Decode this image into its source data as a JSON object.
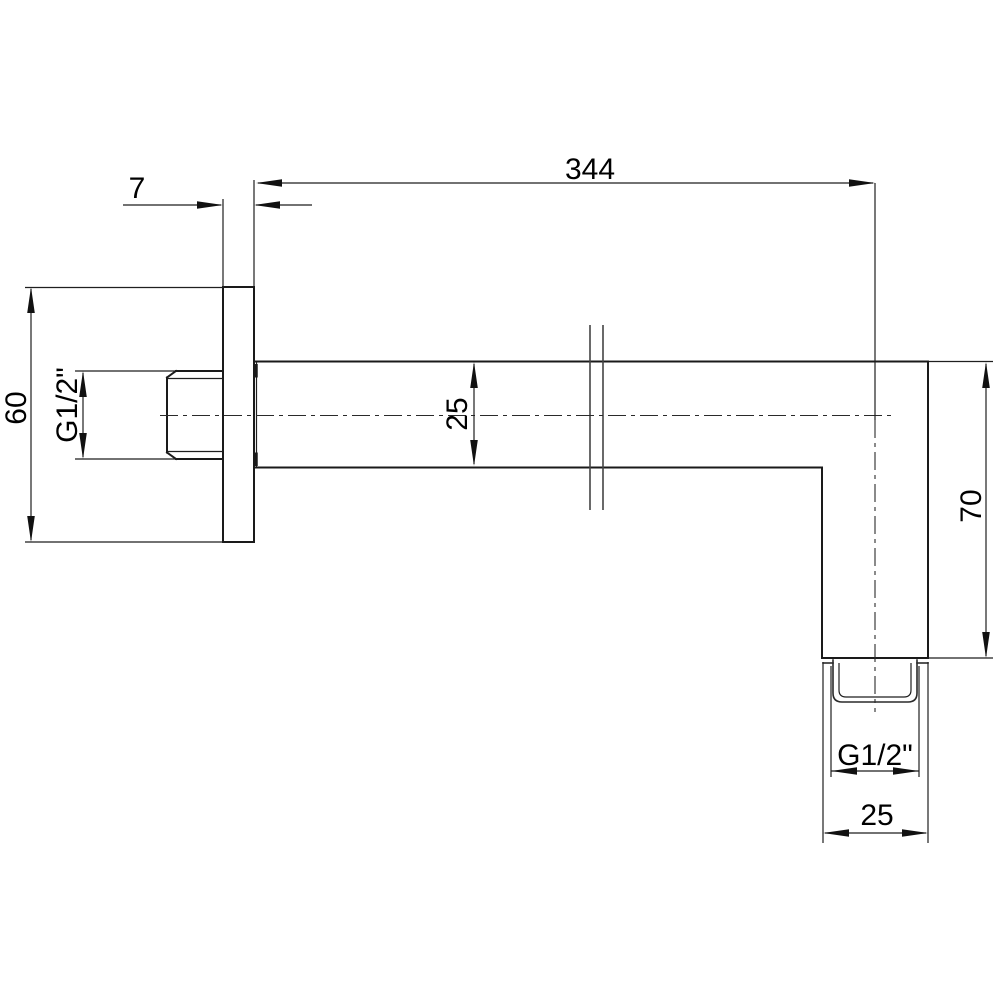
{
  "drawing": {
    "title": "shower-arm-technical-drawing",
    "labels": {
      "flange_thickness": "7",
      "arm_length": "344",
      "flange_size": "60",
      "wall_thread": "G1/2\"",
      "arm_profile": "25",
      "drop_length": "70",
      "outlet_thread": "G1/2\"",
      "outlet_width": "25"
    },
    "colors": {
      "line": "#1a1a1a",
      "background": "#ffffff"
    }
  }
}
